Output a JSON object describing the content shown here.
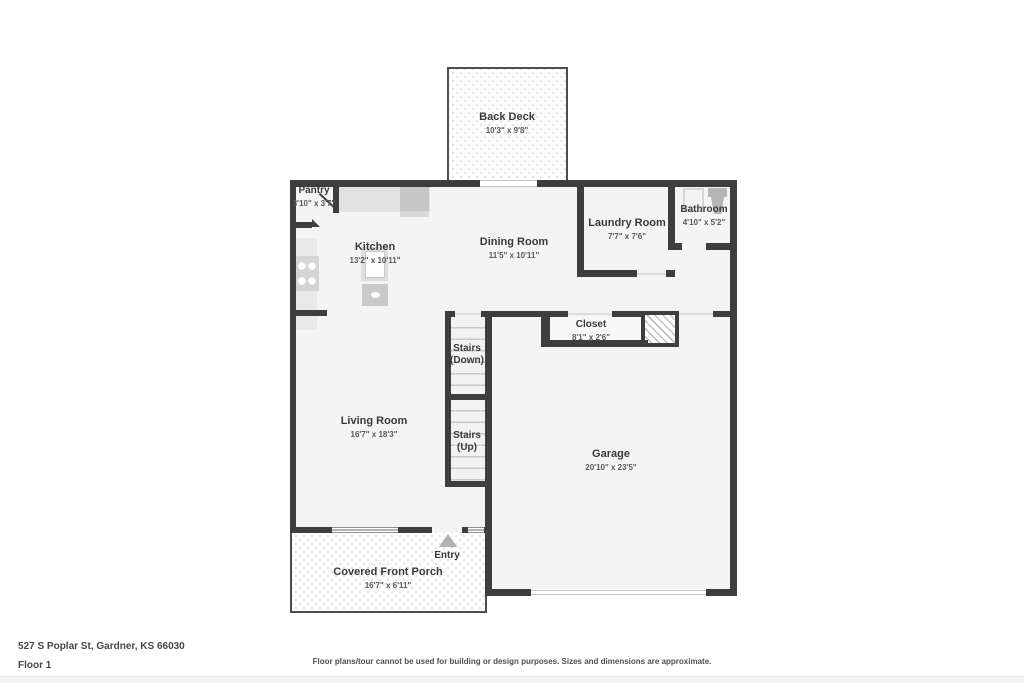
{
  "footer": {
    "address": "527 S Poplar St, Gardner, KS 66030",
    "floor_label": "Floor 1",
    "disclaimer": "Floor plans/tour cannot be used for building or design purposes. Sizes and dimensions are approximate."
  },
  "rooms": {
    "back_deck": {
      "name": "Back Deck",
      "dims": "10'3\" x 9'8\""
    },
    "pantry": {
      "name": "Pantry",
      "dims": "3'10\" x 3'7\""
    },
    "kitchen": {
      "name": "Kitchen",
      "dims": "13'2\" x 10'11\""
    },
    "dining_room": {
      "name": "Dining Room",
      "dims": "11'5\" x 10'11\""
    },
    "laundry_room": {
      "name": "Laundry Room",
      "dims": "7'7\" x 7'6\""
    },
    "bathroom": {
      "name": "Bathroom",
      "dims": "4'10\" x 5'2\""
    },
    "closet": {
      "name": "Closet",
      "dims": "8'1\" x 2'6\""
    },
    "stairs_down": {
      "name": "Stairs",
      "sub": "(Down)"
    },
    "stairs_up": {
      "name": "Stairs",
      "sub": "(Up)"
    },
    "living_room": {
      "name": "Living Room",
      "dims": "16'7\" x 18'3\""
    },
    "garage": {
      "name": "Garage",
      "dims": "20'10\" x 23'5\""
    },
    "entry": {
      "name": "Entry"
    },
    "front_porch": {
      "name": "Covered Front Porch",
      "dims": "16'7\" x 6'11\""
    }
  },
  "icons": {
    "entry_arrow": "triangle-up",
    "stove": "four-burner-cooktop",
    "refrigerator": "refrigerator",
    "island_sink": "kitchen-island-sink",
    "dishwasher": "dishwasher",
    "bath_sink": "bathroom-sink",
    "toilet": "toilet"
  },
  "colors": {
    "wall": "#3e3e3e",
    "floor": "#f4f4f4",
    "deck_dot": "#e3e3e3",
    "text_primary": "#3a3a3a",
    "text_secondary": "#5a5a5a"
  }
}
